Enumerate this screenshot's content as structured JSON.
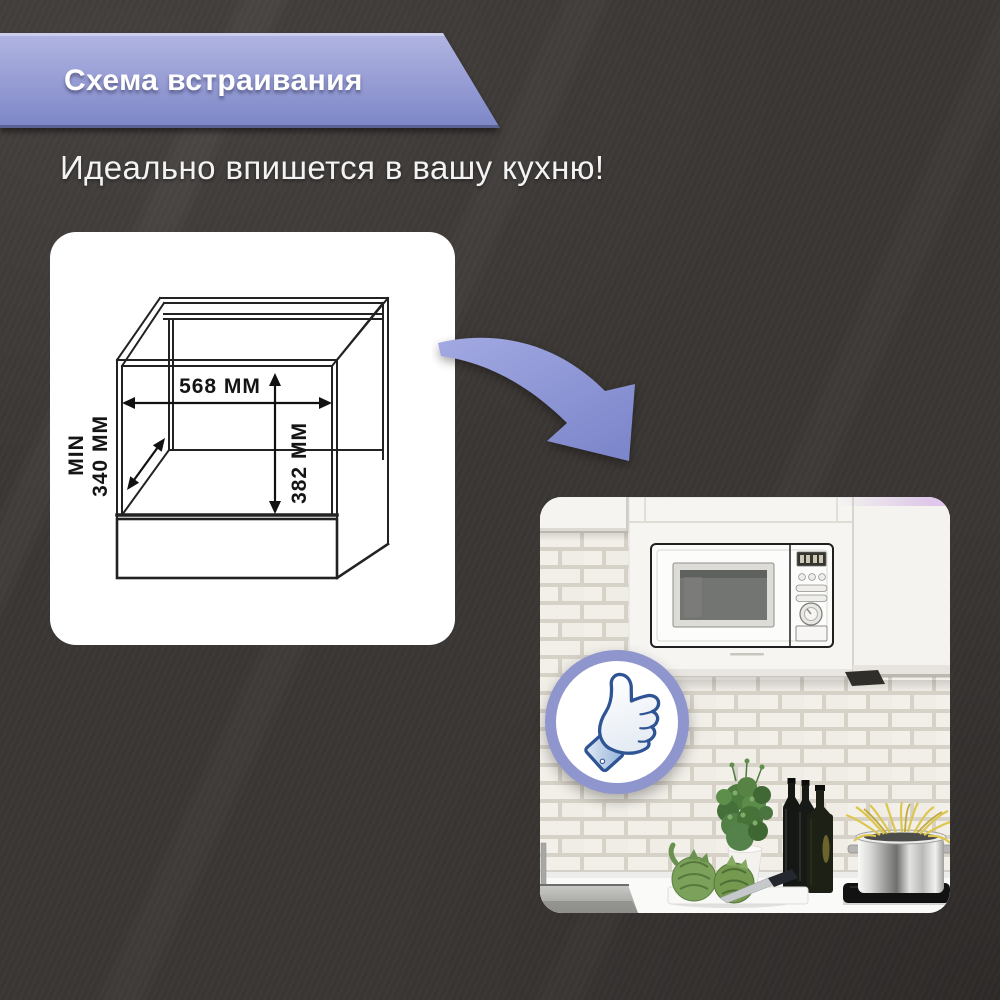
{
  "banner": {
    "title": "Схема встраивания",
    "color_top": "#b0b5e2",
    "color_bottom": "#7c86c6"
  },
  "subtitle": {
    "text": "Идеально впишется в вашу кухню!"
  },
  "diagram": {
    "width_label": "568 MM",
    "height_label": "382 MM",
    "depth_min_label": "MIN",
    "depth_value_label": "340 MM"
  },
  "colors": {
    "page_background": "#3b3735",
    "accent_arrow": "#8d96d6",
    "badge_ring": "#8e96cd",
    "diagram_line": "#1c1c1c"
  },
  "icons": {
    "curved_arrow": "curved-arrow-icon",
    "like": "thumbs-up-icon"
  }
}
